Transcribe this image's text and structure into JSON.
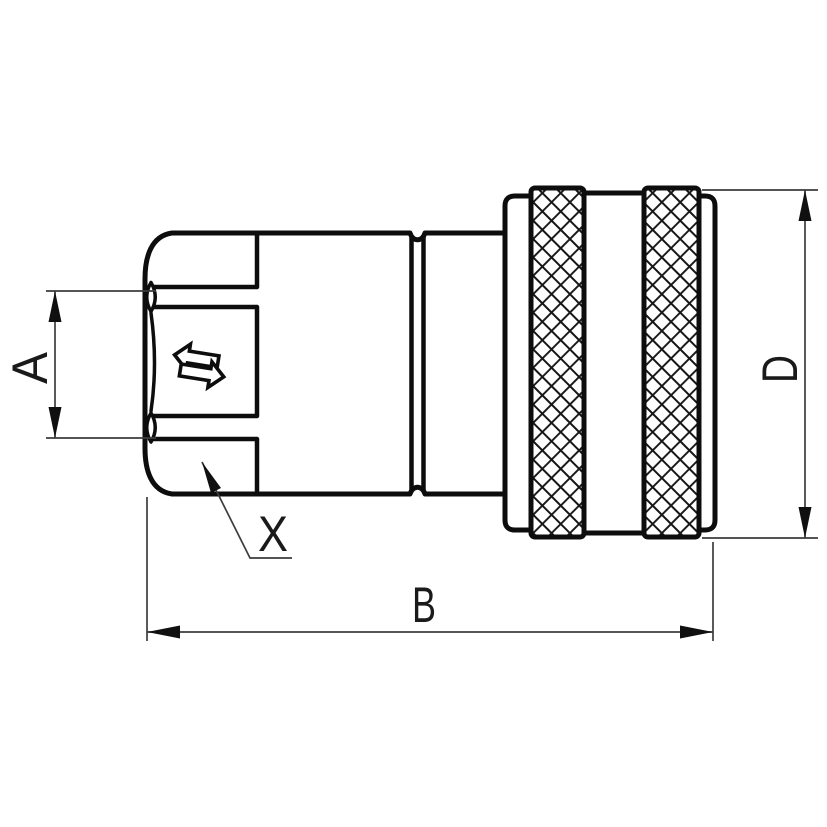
{
  "labels": {
    "dim_a": "A",
    "dim_b": "B",
    "dim_d": "D",
    "detail_x": "X"
  },
  "icons": {
    "flow_arrow": "bidirectional-flow-arrows-icon"
  },
  "colors": {
    "outline": "#0d0d0d",
    "dimension_lines": "#3d3d3d",
    "arrowheads": "#101010",
    "text": "#1a1a1a",
    "background": "#ffffff"
  }
}
